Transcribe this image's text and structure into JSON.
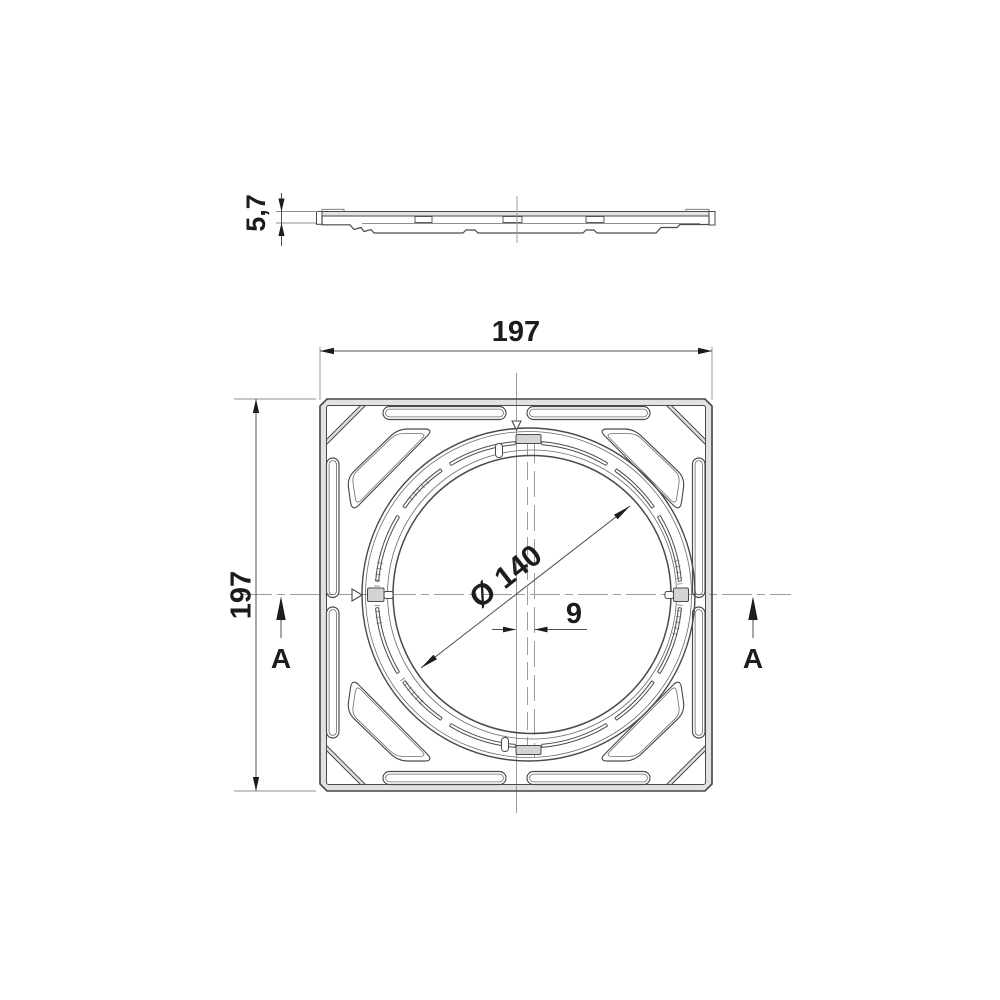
{
  "drawing": {
    "dimensions": {
      "width": "197",
      "height": "197",
      "thickness": "5,7",
      "diameter": "Ø 140",
      "offset": "9"
    },
    "section_labels": {
      "left": "A",
      "right": "A"
    },
    "colors": {
      "background": "#ffffff",
      "object_line": "#4a4a4a",
      "centerline": "#9c9c9c",
      "dimension_line": "#4f4f4f",
      "text": "#1c1c1c",
      "edge_shading": "#e2e2e2"
    }
  }
}
